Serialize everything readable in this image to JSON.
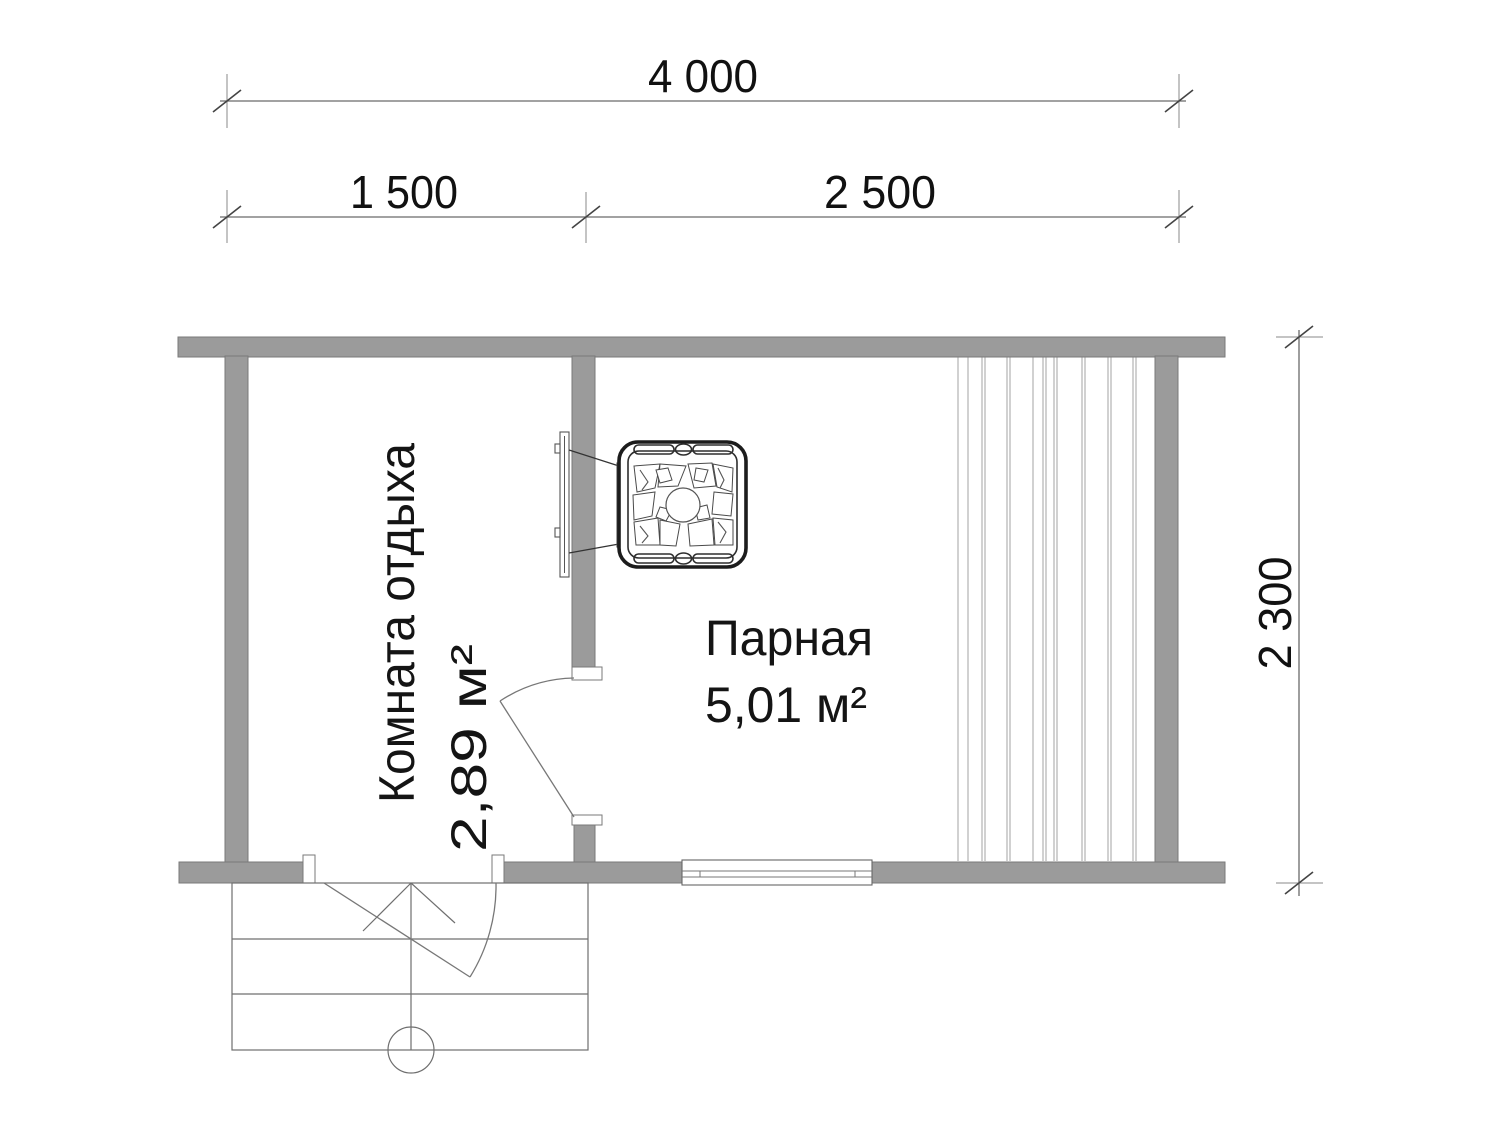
{
  "drawing": {
    "type": "floor-plan",
    "subject": "sauna-plan"
  },
  "dimensions": {
    "overall_width": "4 000",
    "left_section": "1 500",
    "right_section": "2 500",
    "depth": "2 300"
  },
  "rooms": [
    {
      "name": "Комната отдыха",
      "area": "2,89 м²"
    },
    {
      "name": "Парная",
      "area": "5,01 м²"
    }
  ],
  "icons": {
    "stove": "sauna-stove-with-stones",
    "partition_door": "door-swing",
    "entry_door": "door-swing",
    "porch": "entry-steps",
    "post": "porch-post-circle",
    "window": "window-symbol",
    "benches": "bench-boards"
  },
  "colors": {
    "wall_fill": "#9b9b9b",
    "wall_edge": "#7a7a7a",
    "dimension_line": "#6a6a6a",
    "drawing_line": "#777777",
    "stove_line": "#1c1c1c",
    "text": "#111111",
    "background": "#ffffff"
  },
  "benches": {
    "y_top": 357,
    "y_bottom": 861,
    "line_xs": [
      958,
      968,
      982,
      985,
      1007,
      1010,
      1033,
      1043,
      1046,
      1054,
      1057,
      1082,
      1085,
      1108,
      1111,
      1133,
      1136
    ]
  }
}
